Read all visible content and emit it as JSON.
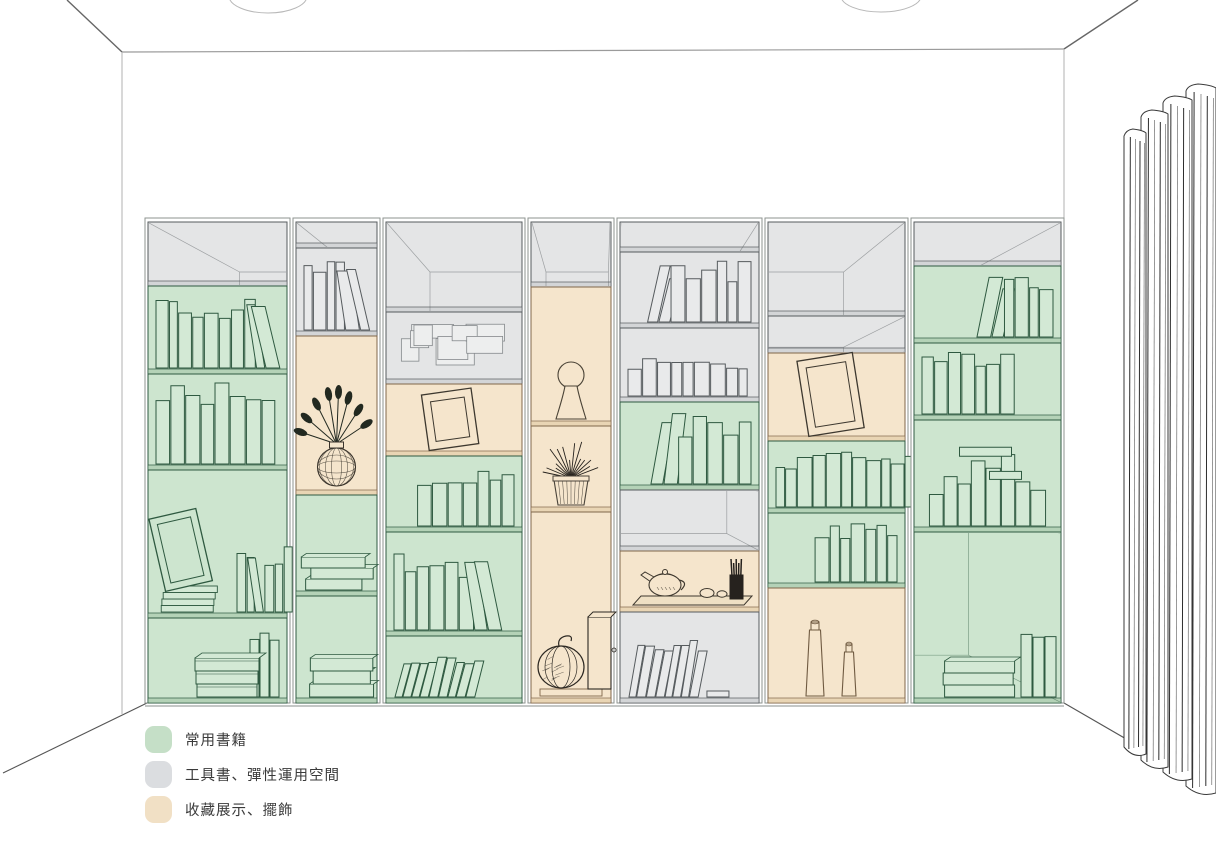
{
  "legend": {
    "items": [
      {
        "label": "常用書籍",
        "color": "#c5dfc7"
      },
      {
        "label": "工具書、彈性運用空間",
        "color": "#dbdde0"
      },
      {
        "label": "收藏展示、擺飾",
        "color": "#f1e0c5"
      }
    ]
  },
  "zones": {
    "green": {
      "label": "常用書籍",
      "fill": "#cde5cf",
      "book": "#d3e9d5",
      "line": "#2e5940",
      "dark": "#b4d2b7"
    },
    "gray": {
      "label": "工具書、彈性運用空間",
      "fill": "#e4e5e6",
      "book": "#e9eaeb",
      "line": "#565b5e",
      "dark": "#d3d5d7"
    },
    "beige": {
      "label": "收藏展示、擺飾",
      "fill": "#f5e5cc",
      "book": "#f7ead6",
      "line": "#80664a",
      "dark": "#e9d5b4"
    }
  },
  "shelf": {
    "x0": 145,
    "x1": 1064,
    "top": 218,
    "bottom": 703,
    "base": 706,
    "columns": [
      {
        "x0": 145,
        "x1": 290,
        "sections": [
          {
            "y0": 222,
            "y1": 286,
            "zone": "gray",
            "persp": true,
            "content": {
              "type": "empty"
            }
          },
          {
            "y0": 286,
            "y1": 374,
            "zone": "green",
            "content": {
              "type": "books",
              "n": 10,
              "align": "center",
              "lean": "right"
            }
          },
          {
            "y0": 374,
            "y1": 470,
            "zone": "green",
            "content": {
              "type": "books",
              "n": 8,
              "align": "left",
              "hf": 0.85
            }
          },
          {
            "y0": 470,
            "y1": 618,
            "zone": "green",
            "content": {
              "type": "frameStackBooks"
            }
          },
          {
            "y0": 618,
            "y1": 703,
            "zone": "green",
            "content": {
              "type": "boxesBooks"
            }
          }
        ]
      },
      {
        "x0": 293,
        "x1": 380,
        "sections": [
          {
            "y0": 222,
            "y1": 248,
            "zone": "gray",
            "persp": true,
            "content": {
              "type": "empty"
            }
          },
          {
            "y0": 248,
            "y1": 336,
            "zone": "gray",
            "content": {
              "type": "books",
              "n": 6,
              "align": "left",
              "lean": "right"
            }
          },
          {
            "y0": 336,
            "y1": 495,
            "zone": "beige",
            "content": {
              "type": "plantVase"
            }
          },
          {
            "y0": 495,
            "y1": 596,
            "zone": "green",
            "content": {
              "type": "stack",
              "n": 3
            }
          },
          {
            "y0": 596,
            "y1": 703,
            "zone": "green",
            "content": {
              "type": "stack",
              "n": 3,
              "thick": true
            }
          }
        ]
      },
      {
        "x0": 383,
        "x1": 525,
        "sections": [
          {
            "y0": 222,
            "y1": 312,
            "zone": "gray",
            "persp": true,
            "content": {
              "type": "empty"
            }
          },
          {
            "y0": 312,
            "y1": 384,
            "zone": "gray",
            "content": {
              "type": "papers"
            }
          },
          {
            "y0": 384,
            "y1": 456,
            "zone": "beige",
            "content": {
              "type": "frame",
              "w": 50,
              "h": 56,
              "tilt": -8
            }
          },
          {
            "y0": 456,
            "y1": 532,
            "zone": "green",
            "content": {
              "type": "books",
              "n": 7,
              "align": "right"
            }
          },
          {
            "y0": 532,
            "y1": 636,
            "zone": "green",
            "content": {
              "type": "books",
              "n": 8,
              "align": "left",
              "lean": "right",
              "hf": 0.72
            }
          },
          {
            "y0": 636,
            "y1": 703,
            "zone": "green",
            "content": {
              "type": "leanRow",
              "n": 9
            }
          }
        ]
      },
      {
        "x0": 528,
        "x1": 614,
        "sections": [
          {
            "y0": 222,
            "y1": 287,
            "zone": "gray",
            "persp": true,
            "content": {
              "type": "empty"
            }
          },
          {
            "y0": 287,
            "y1": 426,
            "zone": "beige",
            "content": {
              "type": "sculpture"
            }
          },
          {
            "y0": 426,
            "y1": 512,
            "zone": "beige",
            "content": {
              "type": "plantPot"
            }
          },
          {
            "y0": 512,
            "y1": 703,
            "zone": "beige",
            "content": {
              "type": "pumpkinBox"
            }
          }
        ]
      },
      {
        "x0": 617,
        "x1": 762,
        "sections": [
          {
            "y0": 222,
            "y1": 252,
            "zone": "gray",
            "persp": true,
            "content": {
              "type": "empty"
            }
          },
          {
            "y0": 252,
            "y1": 328,
            "zone": "gray",
            "content": {
              "type": "books",
              "n": 8,
              "align": "right",
              "lean": "left"
            }
          },
          {
            "y0": 328,
            "y1": 402,
            "zone": "gray",
            "content": {
              "type": "books",
              "n": 9,
              "align": "left",
              "hf": 0.55
            }
          },
          {
            "y0": 402,
            "y1": 490,
            "zone": "green",
            "content": {
              "type": "books",
              "n": 7,
              "align": "right",
              "lean": "left"
            }
          },
          {
            "y0": 490,
            "y1": 551,
            "zone": "gray",
            "persp": true,
            "content": {
              "type": "empty"
            }
          },
          {
            "y0": 551,
            "y1": 612,
            "zone": "beige",
            "content": {
              "type": "teaset"
            }
          },
          {
            "y0": 612,
            "y1": 703,
            "zone": "gray",
            "content": {
              "type": "leanRow",
              "n": 8,
              "flat": true
            }
          }
        ]
      },
      {
        "x0": 765,
        "x1": 908,
        "sections": [
          {
            "y0": 222,
            "y1": 316,
            "zone": "gray",
            "persp": true,
            "content": {
              "type": "empty"
            }
          },
          {
            "y0": 316,
            "y1": 353,
            "zone": "gray",
            "persp": true,
            "content": {
              "type": "empty"
            }
          },
          {
            "y0": 353,
            "y1": 441,
            "zone": "beige",
            "content": {
              "type": "frame",
              "w": 56,
              "h": 76,
              "tilt": -9
            }
          },
          {
            "y0": 441,
            "y1": 513,
            "zone": "green",
            "content": {
              "type": "books",
              "n": 11,
              "align": "full"
            }
          },
          {
            "y0": 513,
            "y1": 588,
            "zone": "green",
            "content": {
              "type": "books",
              "n": 7,
              "align": "right"
            }
          },
          {
            "y0": 588,
            "y1": 703,
            "zone": "beige",
            "content": {
              "type": "vases"
            }
          }
        ]
      },
      {
        "x0": 911,
        "x1": 1064,
        "sections": [
          {
            "y0": 222,
            "y1": 266,
            "zone": "gray",
            "persp": true,
            "content": {
              "type": "empty"
            }
          },
          {
            "y0": 266,
            "y1": 343,
            "zone": "green",
            "content": {
              "type": "books",
              "n": 6,
              "align": "right",
              "lean": "left"
            }
          },
          {
            "y0": 343,
            "y1": 420,
            "zone": "green",
            "content": {
              "type": "books",
              "n": 7,
              "align": "left"
            }
          },
          {
            "y0": 420,
            "y1": 532,
            "zone": "green",
            "content": {
              "type": "cluster"
            }
          },
          {
            "y0": 532,
            "y1": 703,
            "zone": "green",
            "persp": true,
            "content": {
              "type": "stackBooks"
            }
          }
        ]
      }
    ]
  }
}
